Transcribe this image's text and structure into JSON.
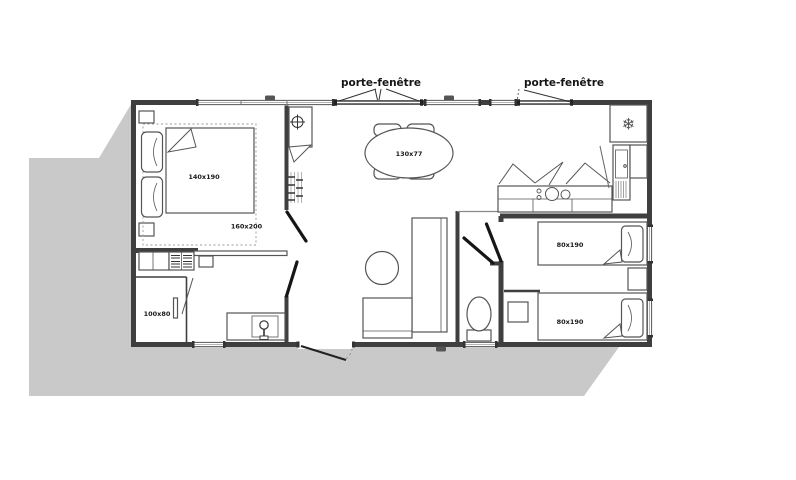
{
  "plan": {
    "title": "mobile-home floor plan",
    "labels": {
      "porte_fenetre_1": "porte-fenêtre",
      "porte_fenetre_2": "porte-fenêtre"
    },
    "dimensions": {
      "master_bed": "140x190",
      "master_bed_outline": "160x200",
      "dining_table": "130x77",
      "shower": "100x80",
      "single_bed_1": "80x190",
      "single_bed_2": "80x190"
    },
    "icons": {
      "fridge_snowflake": "❄"
    },
    "colors": {
      "wall": "#3f3f3f",
      "furniture_line": "#555555",
      "shadow": "#c9c9c9",
      "door_leaf": "#161616",
      "background": "#ffffff"
    }
  }
}
